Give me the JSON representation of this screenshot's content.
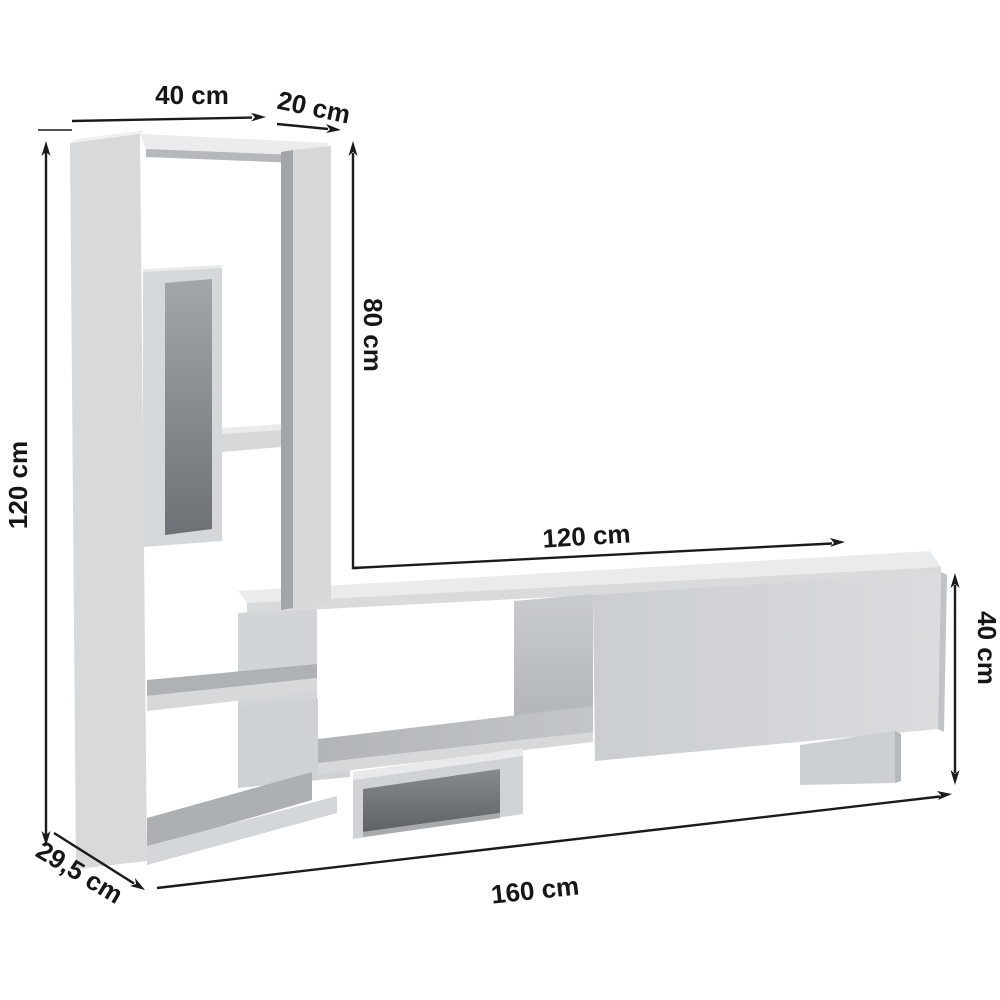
{
  "drawing": {
    "product": "Wall TV unit with shelving column - dimensional drawing",
    "unit": "cm",
    "line_color": "#1b1b1b",
    "furniture_fill": "#d7d9db",
    "background": "#ffffff",
    "dimensions": {
      "column_top_width": {
        "label": "40 cm",
        "value": 40
      },
      "column_top_depth": {
        "label": "20 cm",
        "value": 20
      },
      "upper_section_height": {
        "label": "80 cm",
        "value": 80
      },
      "total_height": {
        "label": "120 cm",
        "value": 120
      },
      "bench_top_length": {
        "label": "120 cm",
        "value": 120
      },
      "bench_height": {
        "label": "40 cm",
        "value": 40
      },
      "base_depth": {
        "label": "29,5 cm",
        "value": 29.5
      },
      "total_length": {
        "label": "160 cm",
        "value": 160
      }
    }
  }
}
